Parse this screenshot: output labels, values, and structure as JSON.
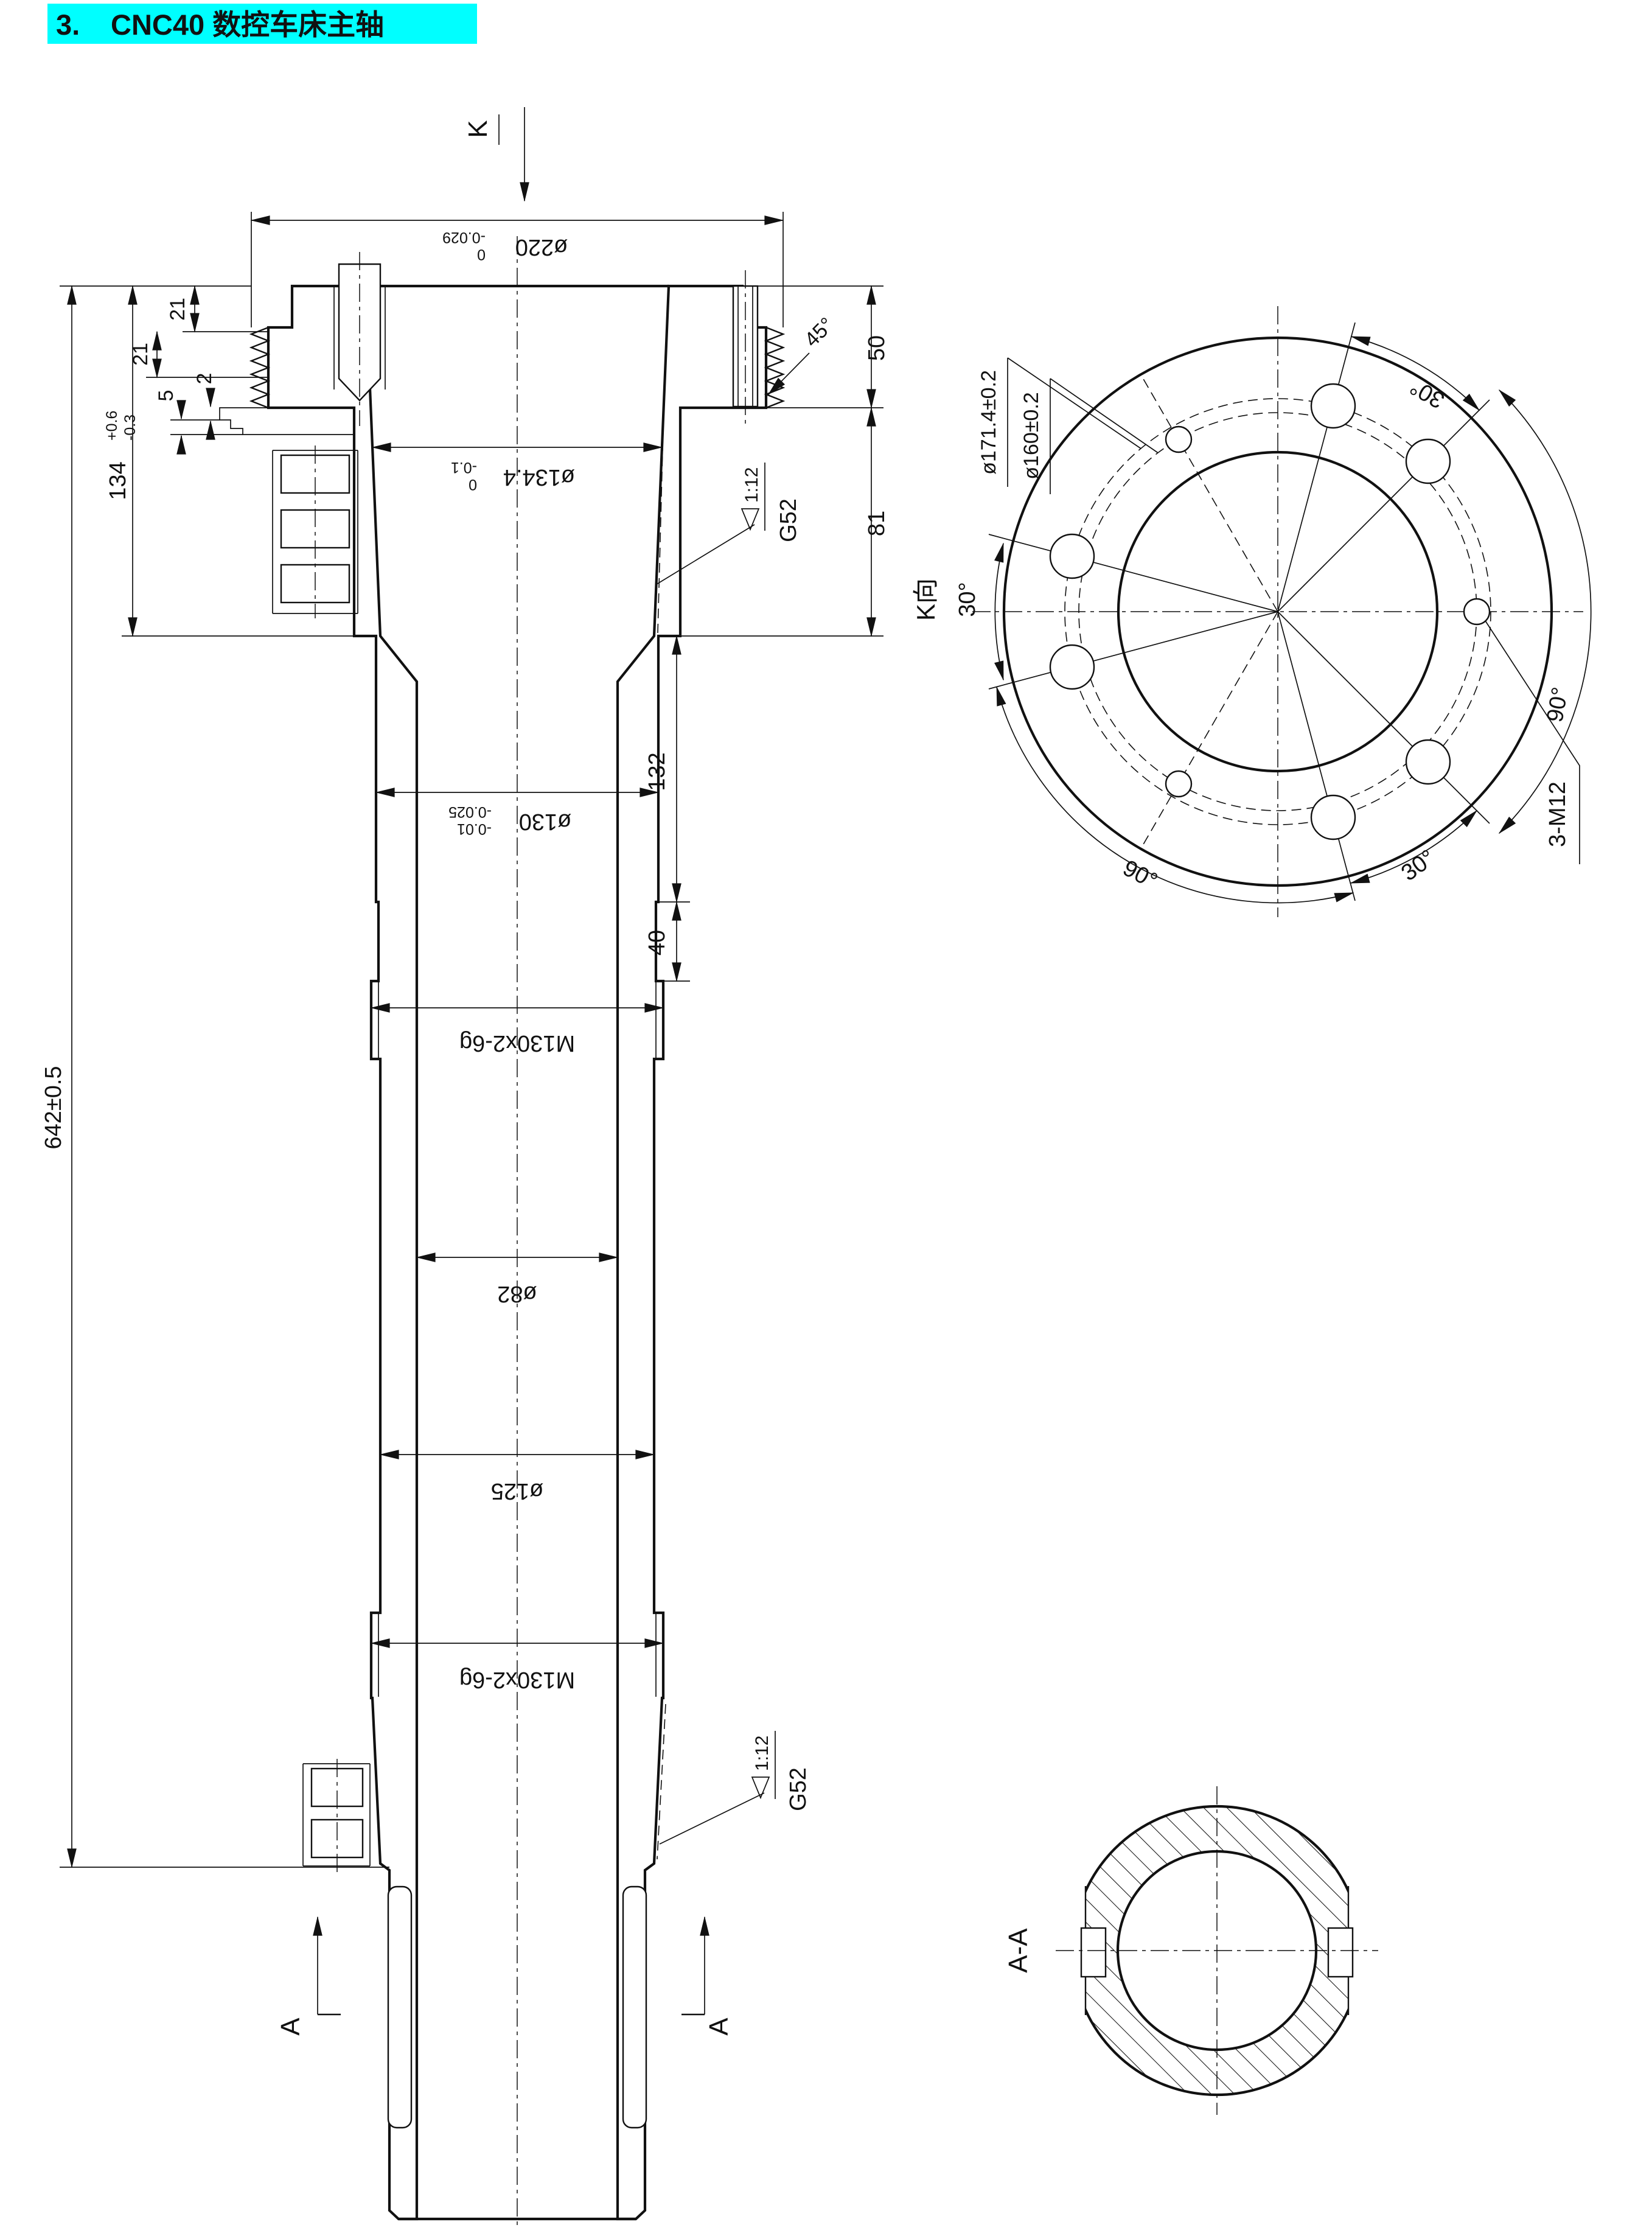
{
  "title": {
    "prefix": "3.",
    "text": "CNC40 数控车床主轴"
  },
  "colors": {
    "highlight": "#00ffff",
    "ink": "#111111"
  },
  "main_view": {
    "k_arrow": "K",
    "dims": {
      "od220": {
        "v": "ø220",
        "sup": "0",
        "sub": "-0.029"
      },
      "len134": {
        "v": "134",
        "sup": "+0.6",
        "sub": "-0.3"
      },
      "len21a": "21",
      "len21b": "21",
      "len5": "5",
      "len2": "2",
      "len50": "50",
      "len81": "81",
      "len132": "132",
      "len40": "40",
      "len642": "642±0.5",
      "bore134": {
        "v": "ø134.4",
        "sup": "0",
        "sub": "-0.1"
      },
      "od130": {
        "v": "ø130",
        "sup": "-0.01",
        "sub": "-0.025"
      },
      "thread_upper": "M130x2-6g",
      "bore82": "ø82",
      "od125": "ø125",
      "thread_lower": "M130x2-6g",
      "chamfer45": "45°"
    },
    "taper_note_upper": {
      "ratio": "1:12",
      "gauge": "G52"
    },
    "taper_note_lower": {
      "ratio": "1:12",
      "gauge": "G52"
    },
    "section_label": "A"
  },
  "k_view": {
    "name": "K向",
    "bolt_circle_1": "ø171.4±0.2",
    "bolt_circle_2": "ø160±0.2",
    "angle_left": "30°",
    "angle_top_right": "30°",
    "angle_right": "90°",
    "angle_bottom_left": "90°",
    "angle_bottom_right": "30°",
    "tapped_holes": "3-M12"
  },
  "aa_view": {
    "label": "A-A"
  }
}
